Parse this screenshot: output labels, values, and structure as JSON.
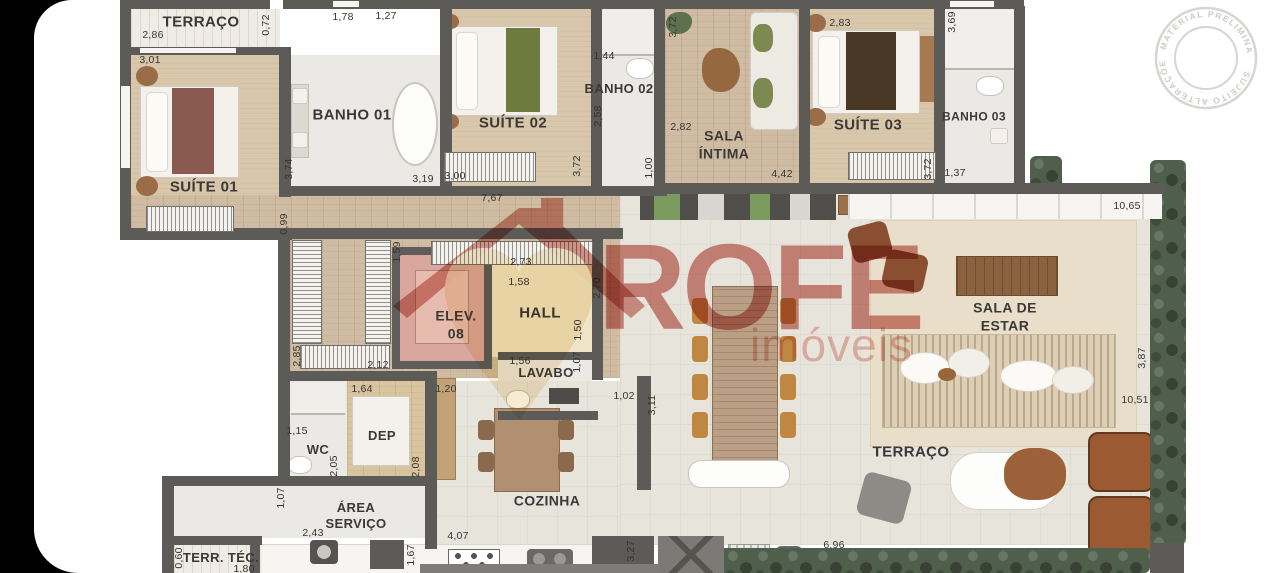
{
  "colors": {
    "wall": "#5c5b58",
    "logo_salmon": "#cf8177",
    "heart_cream": "#f7ead0",
    "stamp_gray": "#cdccc8",
    "hedge_green": "#4f5f4c"
  },
  "logo": {
    "name": "ROFE",
    "tagline": "imóveis"
  },
  "stamp": {
    "top_text": "MATERIAL PRELIMINAR",
    "bottom_text": "SUJEITO ALTERAÇÕES"
  },
  "room_labels": [
    {
      "id": "terraco-top",
      "label": "TERRAÇO",
      "x": 201,
      "y": 23,
      "fs": 15
    },
    {
      "id": "suite-01",
      "label": "SUÍTE 01",
      "x": 204,
      "y": 188,
      "fs": 15
    },
    {
      "id": "banho-01",
      "label": "BANHO 01",
      "x": 352,
      "y": 116,
      "fs": 15
    },
    {
      "id": "suite-02",
      "label": "SUÍTE 02",
      "x": 513,
      "y": 124,
      "fs": 15
    },
    {
      "id": "banho-02",
      "label": "BANHO 02",
      "x": 619,
      "y": 89,
      "fs": 13
    },
    {
      "id": "sala-intima",
      "label": "SALA\nÍNTIMA",
      "x": 724,
      "y": 145,
      "fs": 14
    },
    {
      "id": "suite-03",
      "label": "SUÍTE 03",
      "x": 868,
      "y": 126,
      "fs": 15
    },
    {
      "id": "banho-03",
      "label": "BANHO 03",
      "x": 974,
      "y": 117,
      "fs": 12
    },
    {
      "id": "elev-08",
      "label": "ELEV.\n08",
      "x": 456,
      "y": 325,
      "fs": 14
    },
    {
      "id": "hall",
      "label": "HALL",
      "x": 540,
      "y": 314,
      "fs": 15
    },
    {
      "id": "lavabo",
      "label": "LAVABO",
      "x": 546,
      "y": 373,
      "fs": 13
    },
    {
      "id": "wc",
      "label": "WC",
      "x": 318,
      "y": 450,
      "fs": 13
    },
    {
      "id": "dep",
      "label": "DEP",
      "x": 382,
      "y": 436,
      "fs": 13
    },
    {
      "id": "area-servico",
      "label": "ÁREA\nSERVIÇO",
      "x": 356,
      "y": 516,
      "fs": 13
    },
    {
      "id": "cozinha",
      "label": "COZINHA",
      "x": 547,
      "y": 501,
      "fs": 14
    },
    {
      "id": "terraco-bottom",
      "label": "TERRAÇO",
      "x": 911,
      "y": 453,
      "fs": 15
    },
    {
      "id": "terr-tec",
      "label": "TERR. TÉC.",
      "x": 221,
      "y": 558,
      "fs": 13
    },
    {
      "id": "sala-de-estar",
      "label": "SALA DE\nESTAR",
      "x": 1005,
      "y": 317,
      "fs": 14
    }
  ],
  "dim_labels": [
    {
      "t": "2,86",
      "x": 153,
      "y": 35,
      "r": 0
    },
    {
      "t": "3,01",
      "x": 150,
      "y": 60,
      "r": 0
    },
    {
      "t": "0,72",
      "x": 266,
      "y": 25,
      "r": 1
    },
    {
      "t": "1,78",
      "x": 343,
      "y": 17,
      "r": 0
    },
    {
      "t": "1,27",
      "x": 386,
      "y": 16,
      "r": 0
    },
    {
      "t": "1,44",
      "x": 604,
      "y": 56,
      "r": 0
    },
    {
      "t": "2,83",
      "x": 840,
      "y": 23,
      "r": 0
    },
    {
      "t": "3,69",
      "x": 952,
      "y": 22,
      "r": 1
    },
    {
      "t": "3,74",
      "x": 289,
      "y": 169,
      "r": 1
    },
    {
      "t": "3,19",
      "x": 423,
      "y": 179,
      "r": 0
    },
    {
      "t": "3,00",
      "x": 455,
      "y": 176,
      "r": 0
    },
    {
      "t": "2,58",
      "x": 598,
      "y": 116,
      "r": 1
    },
    {
      "t": "2,82",
      "x": 681,
      "y": 127,
      "r": 0
    },
    {
      "t": "3,72",
      "x": 673,
      "y": 27,
      "r": 1
    },
    {
      "t": "3,72",
      "x": 577,
      "y": 166,
      "r": 1
    },
    {
      "t": "3,72",
      "x": 928,
      "y": 169,
      "r": 1
    },
    {
      "t": "1,37",
      "x": 955,
      "y": 173,
      "r": 0
    },
    {
      "t": "1,00",
      "x": 649,
      "y": 168,
      "r": 1
    },
    {
      "t": "4,42",
      "x": 782,
      "y": 174,
      "r": 0
    },
    {
      "t": "7,67",
      "x": 492,
      "y": 198,
      "r": 0
    },
    {
      "t": "0,99",
      "x": 284,
      "y": 224,
      "r": 1
    },
    {
      "t": "10,65",
      "x": 1127,
      "y": 206,
      "r": 0
    },
    {
      "t": "1,59",
      "x": 397,
      "y": 252,
      "r": 1
    },
    {
      "t": "2,73",
      "x": 521,
      "y": 262,
      "r": 0
    },
    {
      "t": "1,58",
      "x": 519,
      "y": 282,
      "r": 0
    },
    {
      "t": "2,70",
      "x": 597,
      "y": 288,
      "r": 1
    },
    {
      "t": "1,50",
      "x": 578,
      "y": 330,
      "r": 1
    },
    {
      "t": "1,56",
      "x": 520,
      "y": 361,
      "r": 0
    },
    {
      "t": "1,07",
      "x": 577,
      "y": 362,
      "r": 1
    },
    {
      "t": "2,85",
      "x": 297,
      "y": 356,
      "r": 1
    },
    {
      "t": "2,12",
      "x": 378,
      "y": 365,
      "r": 0
    },
    {
      "t": "1,64",
      "x": 362,
      "y": 389,
      "r": 0
    },
    {
      "t": "1,20",
      "x": 446,
      "y": 389,
      "r": 0
    },
    {
      "t": "1,15",
      "x": 297,
      "y": 431,
      "r": 0
    },
    {
      "t": "2,05",
      "x": 334,
      "y": 466,
      "r": 1
    },
    {
      "t": "2,08",
      "x": 416,
      "y": 467,
      "r": 1
    },
    {
      "t": "1,07",
      "x": 281,
      "y": 498,
      "r": 1
    },
    {
      "t": "2,43",
      "x": 313,
      "y": 533,
      "r": 0
    },
    {
      "t": "1,02",
      "x": 624,
      "y": 396,
      "r": 0
    },
    {
      "t": "3,11",
      "x": 652,
      "y": 405,
      "r": 1
    },
    {
      "t": "3,87",
      "x": 1142,
      "y": 358,
      "r": 1
    },
    {
      "t": "10,51",
      "x": 1135,
      "y": 400,
      "r": 0
    },
    {
      "t": "1,67",
      "x": 411,
      "y": 555,
      "r": 1
    },
    {
      "t": "4,07",
      "x": 458,
      "y": 536,
      "r": 0
    },
    {
      "t": "3,27",
      "x": 631,
      "y": 551,
      "r": 1
    },
    {
      "t": "6,96",
      "x": 834,
      "y": 545,
      "r": 0
    },
    {
      "t": "0,60",
      "x": 179,
      "y": 558,
      "r": 1
    },
    {
      "t": "1,80",
      "x": 244,
      "y": 569,
      "r": 0
    }
  ]
}
